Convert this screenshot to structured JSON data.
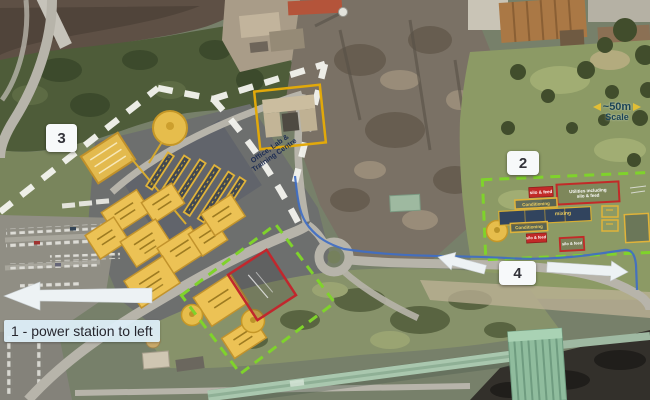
{
  "annotations": {
    "marker_3": "3",
    "marker_2": "2",
    "marker_4": "4",
    "note_1": "1 - power station to left",
    "scale_distance": "~50m",
    "scale_caption": "Scale",
    "office_line1": "Office, Lab &",
    "office_line2": "Training Centre",
    "area2_silo_feed_top": "silo & feed",
    "area2_utilities_line1": "Utilities including",
    "area2_utilities_line2": "silo & feed",
    "area2_conditioning_upper": "Conditioning",
    "area2_mixing": "mixing",
    "area2_conditioning_lower": "Conditioning",
    "area2_silo_feed_mid": "silo & feed",
    "area2_silo_feed_bottom": "silo & feed"
  },
  "colors": {
    "annotation_yellow": "#e8bc4a",
    "annotation_red": "#c1272d",
    "boundary_green": "#7fd32b",
    "boundary_white": "#f4f4ef",
    "route_blue": "#3f6ec4",
    "marker_background": "#f7f9fa",
    "note_background": "#ddeef8"
  }
}
